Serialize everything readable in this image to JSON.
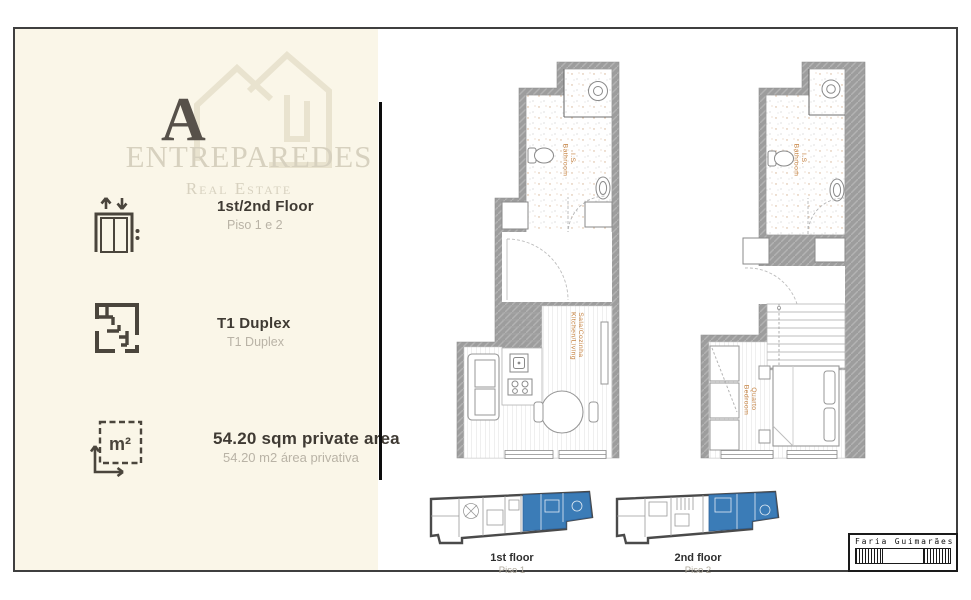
{
  "brand": {
    "letter": "A",
    "name": "ENTREPAREDES",
    "tagline": "Real Estate"
  },
  "specs": [
    {
      "icon": "elevator-icon",
      "label": "1st/2nd Floor",
      "sublabel": "Piso 1 e 2"
    },
    {
      "icon": "floorplan-icon",
      "label": "T1 Duplex",
      "sublabel": "T1 Duplex"
    },
    {
      "icon": "area-icon",
      "icon_label": "m²",
      "label": "54.20 sqm private area",
      "sublabel": "54.20 m2 área privativa"
    }
  ],
  "plans": {
    "floor1": {
      "bathroom_pt": "I.S.",
      "bathroom_en": "Bathroom",
      "living_pt": "Sala/Cozinha",
      "living_en": "Kitchen/Living"
    },
    "floor2": {
      "bathroom_pt": "I.S.",
      "bathroom_en": "Bathroom",
      "bedroom_pt": "Quarto",
      "bedroom_en": "Bedroom"
    }
  },
  "thumbnails": [
    {
      "label": "1st floor",
      "sublabel": "Piso 1"
    },
    {
      "label": "2nd floor",
      "sublabel": "Piso 2"
    }
  ],
  "stamp": {
    "name": "Faria Guimarães"
  },
  "colors": {
    "cream": "#faf6e8",
    "wall_gray": "#9c9c9c",
    "accent_orange": "#c5813f",
    "highlight_blue": "#3b7cb7",
    "dark_text": "#3f3a33",
    "muted_text": "#b9b3a6",
    "logo_beige": "#e9e3cf",
    "brand_text": "#d7d1bf"
  }
}
